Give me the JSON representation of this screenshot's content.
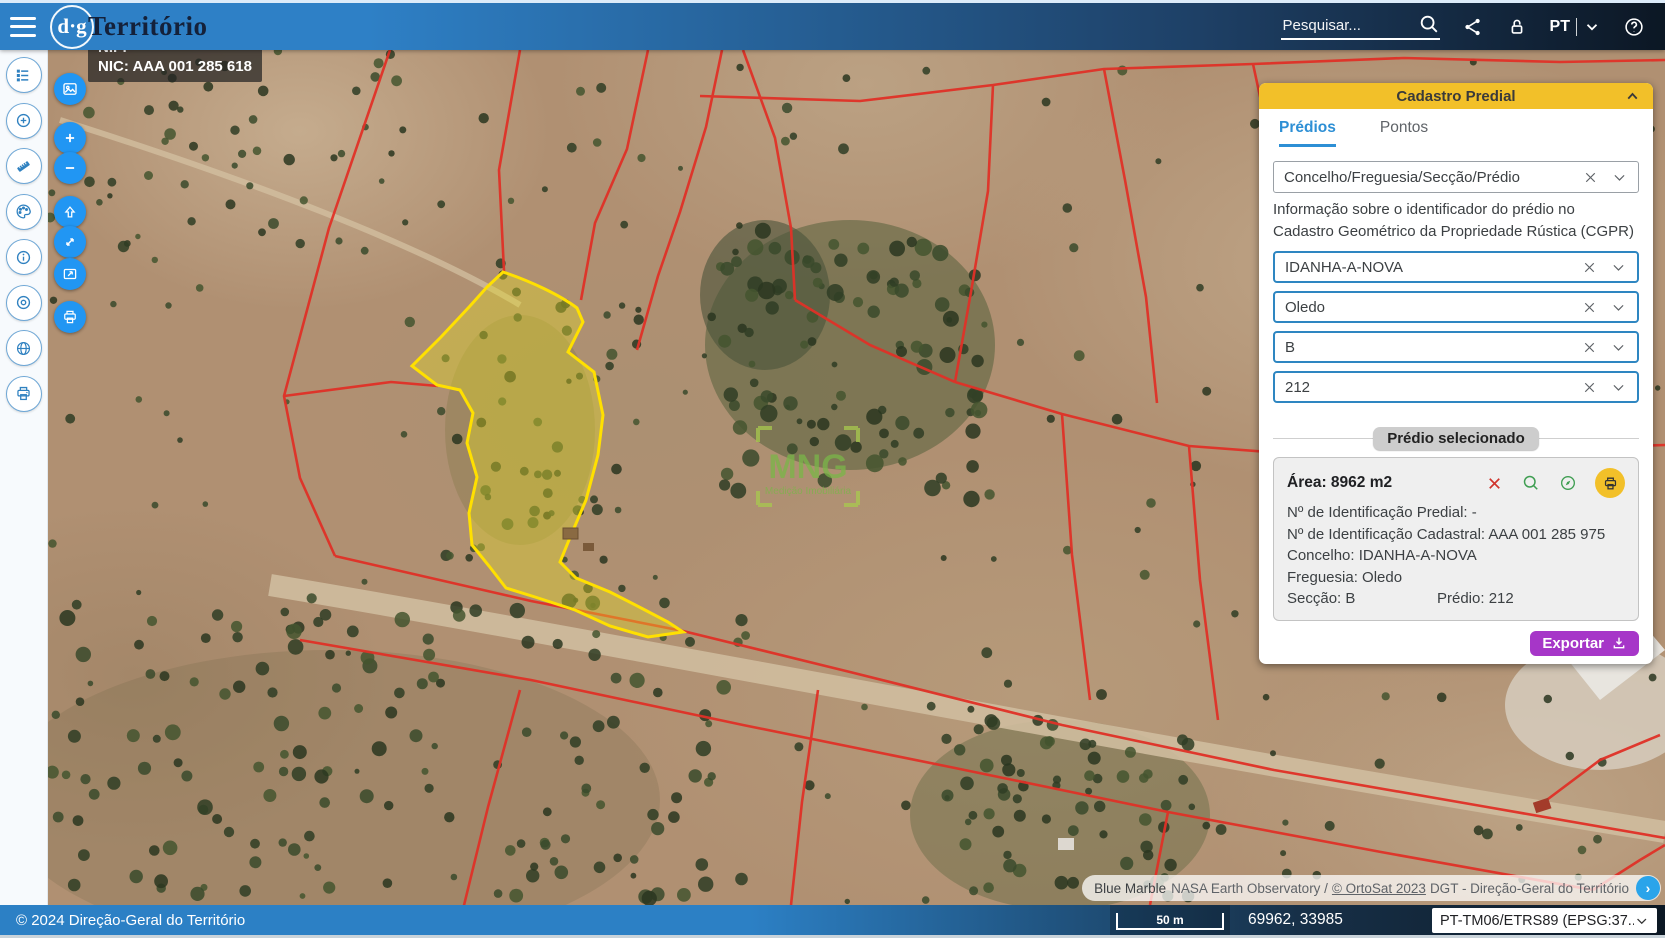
{
  "colors": {
    "header_yellow": "#F2C029",
    "accent_blue": "#2E86C1",
    "tab_blue": "#2D8FD5",
    "export_purple": "#A636C8",
    "parcel_yellow": "#FFE000",
    "boundary_red": "#E03127",
    "button_blue": "#2196F3"
  },
  "topbar": {
    "brand_circle": "d·g",
    "brand_name": "Território",
    "search_placeholder": "Pesquisar...",
    "language": "PT"
  },
  "map": {
    "tooltip": {
      "line1": "NIF: -",
      "line2": "NIC: AAA 001 285 618"
    },
    "watermark": {
      "title": "MNG",
      "subtitle": "Medição Imobiliária"
    }
  },
  "panel": {
    "title": "Cadastro Predial",
    "tabs": [
      {
        "label": "Prédios"
      },
      {
        "label": "Pontos"
      }
    ],
    "filter_label": "Concelho/Freguesia/Secção/Prédio",
    "info_text": "Informação sobre o identificador do prédio no Cadastro Geométrico da Propriedade Rústica (CGPR)",
    "selects": [
      {
        "value": "IDANHA-A-NOVA"
      },
      {
        "value": "Oledo"
      },
      {
        "value": "B"
      },
      {
        "value": "212"
      }
    ],
    "selected_divider": "Prédio selecionado",
    "property": {
      "area_label": "Área: 8962 m2",
      "row1": "Nº de Identificação Predial: -",
      "row2": "Nº de Identificação Cadastral: AAA 001 285 975",
      "row3": "Concelho: IDANHA-A-NOVA",
      "row4": "Freguesia: Oledo",
      "seccao": "Secção: B",
      "predio": "Prédio: 212"
    },
    "export_label": "Exportar"
  },
  "attribution": {
    "part1": "Blue Marble",
    "part2": "NASA Earth Observatory / ",
    "part3": "© OrtoSat 2023",
    "part4": "DGT - Direção-Geral do Território",
    "more": "›"
  },
  "bottombar": {
    "copyright": "© 2024 Direção-Geral do Território",
    "scale_label": "50 m",
    "coordinates": "69962, 33985",
    "crs": "PT-TM06/ETRS89 (EPSG:37..."
  }
}
